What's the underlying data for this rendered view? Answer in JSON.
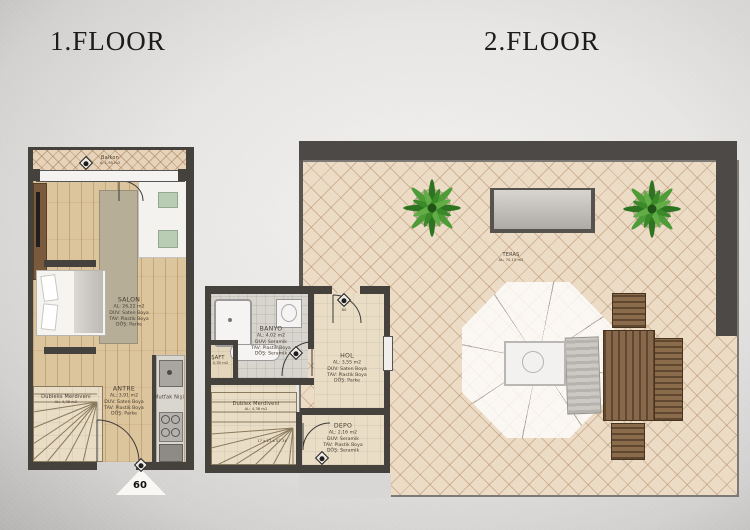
{
  "titles": {
    "floor1": "1.FLOOR",
    "floor2": "2.FLOOR"
  },
  "floor1": {
    "balkon": {
      "name": "Balkon",
      "area": "A: 1,95 m2"
    },
    "salon": {
      "name": "SALON",
      "l1": "AL: 26,22 m2",
      "l2": "DUV: Saten Boya",
      "l3": "TAV: Plastik Boya",
      "l4": "DÖŞ: Parke"
    },
    "antre": {
      "name": "ANTRE",
      "l1": "AL: 3,91 m2",
      "l2": "DUV: Saten Boya",
      "l3": "TAV: Plastik Boya",
      "l4": "DÖŞ: Parke"
    },
    "merdiven": {
      "name": "Dubleks Merdiveni",
      "l1": "AL: 4,38 m2"
    },
    "mutfak": {
      "name": "Mutfak Nişi"
    },
    "door_width": "60"
  },
  "floor2": {
    "teras": {
      "name": "TERAS",
      "l1": "AL: 70,15 m2"
    },
    "banyo": {
      "name": "BANYO",
      "l1": "AL: 4,02 m2",
      "l2": "DUV: Seramik",
      "l3": "TAV: Plastik Boya",
      "l4": "DÖŞ: Seramik"
    },
    "hol": {
      "name": "HOL",
      "l1": "AL: 3,55 m2",
      "l2": "DUV: Saten Boya",
      "l3": "TAV: Plastik Boya",
      "l4": "DÖŞ: Parke"
    },
    "depo": {
      "name": "DEPO",
      "l1": "AL: 2,16 m2",
      "l2": "DUV: Seramik",
      "l3": "TAV: Plastik Boya",
      "l4": "DÖŞ: Seramik"
    },
    "saft": {
      "name": "ŞAFT",
      "l1": "A: 0,30 m2"
    },
    "merdiven": {
      "name": "Dublex Merdiveni",
      "l1": "AL: 4,38 m2",
      "steps": "17 x 27 x 57.34"
    },
    "door_width": "80"
  },
  "colors": {
    "wall": "#45413d",
    "tile": "#ecdcc6",
    "wood": "#dcc49c",
    "plant_green": "#3b8a2a"
  }
}
